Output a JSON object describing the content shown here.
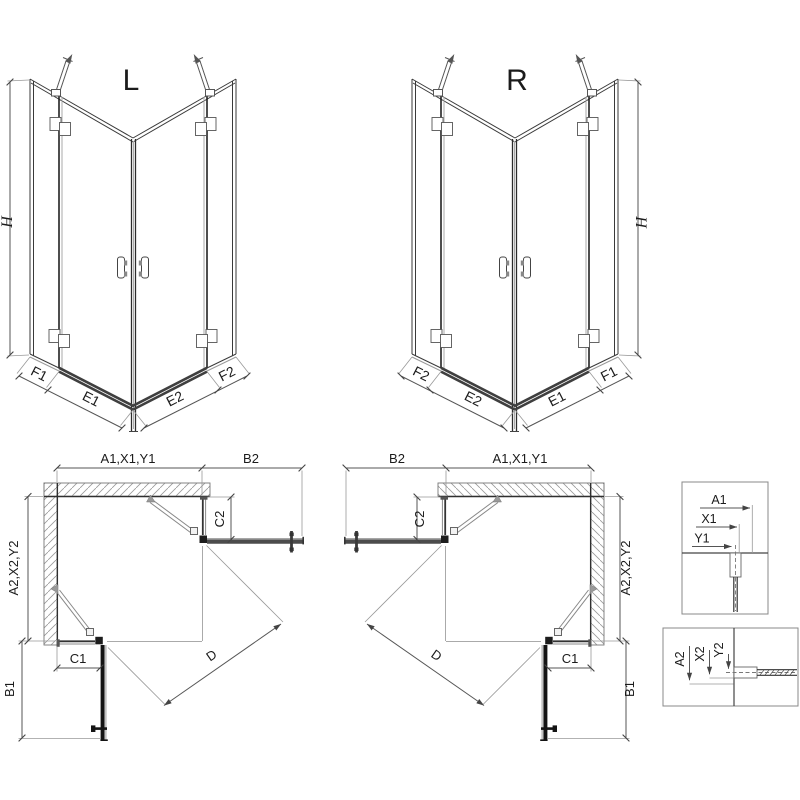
{
  "titles": {
    "left_variant": "L",
    "right_variant": "R"
  },
  "dims": {
    "height": "H",
    "front_left_fixed": "F1",
    "front_left_door": "E1",
    "front_right_door": "E2",
    "front_right_fixed": "F2",
    "plan_width": "A1,X1,Y1",
    "plan_depth": "A2,X2,Y2",
    "door_swing_top": "B2",
    "door_swing_side": "B1",
    "fixed_panel_top": "C2",
    "fixed_panel_side": "C1",
    "entry_diagonal": "D",
    "detail_a1": "A1",
    "detail_x1": "X1",
    "detail_y1": "Y1",
    "detail_a2": "A2",
    "detail_x2": "X2",
    "detail_y2": "Y2"
  },
  "colors": {
    "line": "#3a3a3a",
    "dim_line": "#555555",
    "light_line": "#999999",
    "door_dark": "#141414",
    "door_gray": "#4c4c4c",
    "wall_outline": "#777777",
    "background": "#ffffff"
  }
}
